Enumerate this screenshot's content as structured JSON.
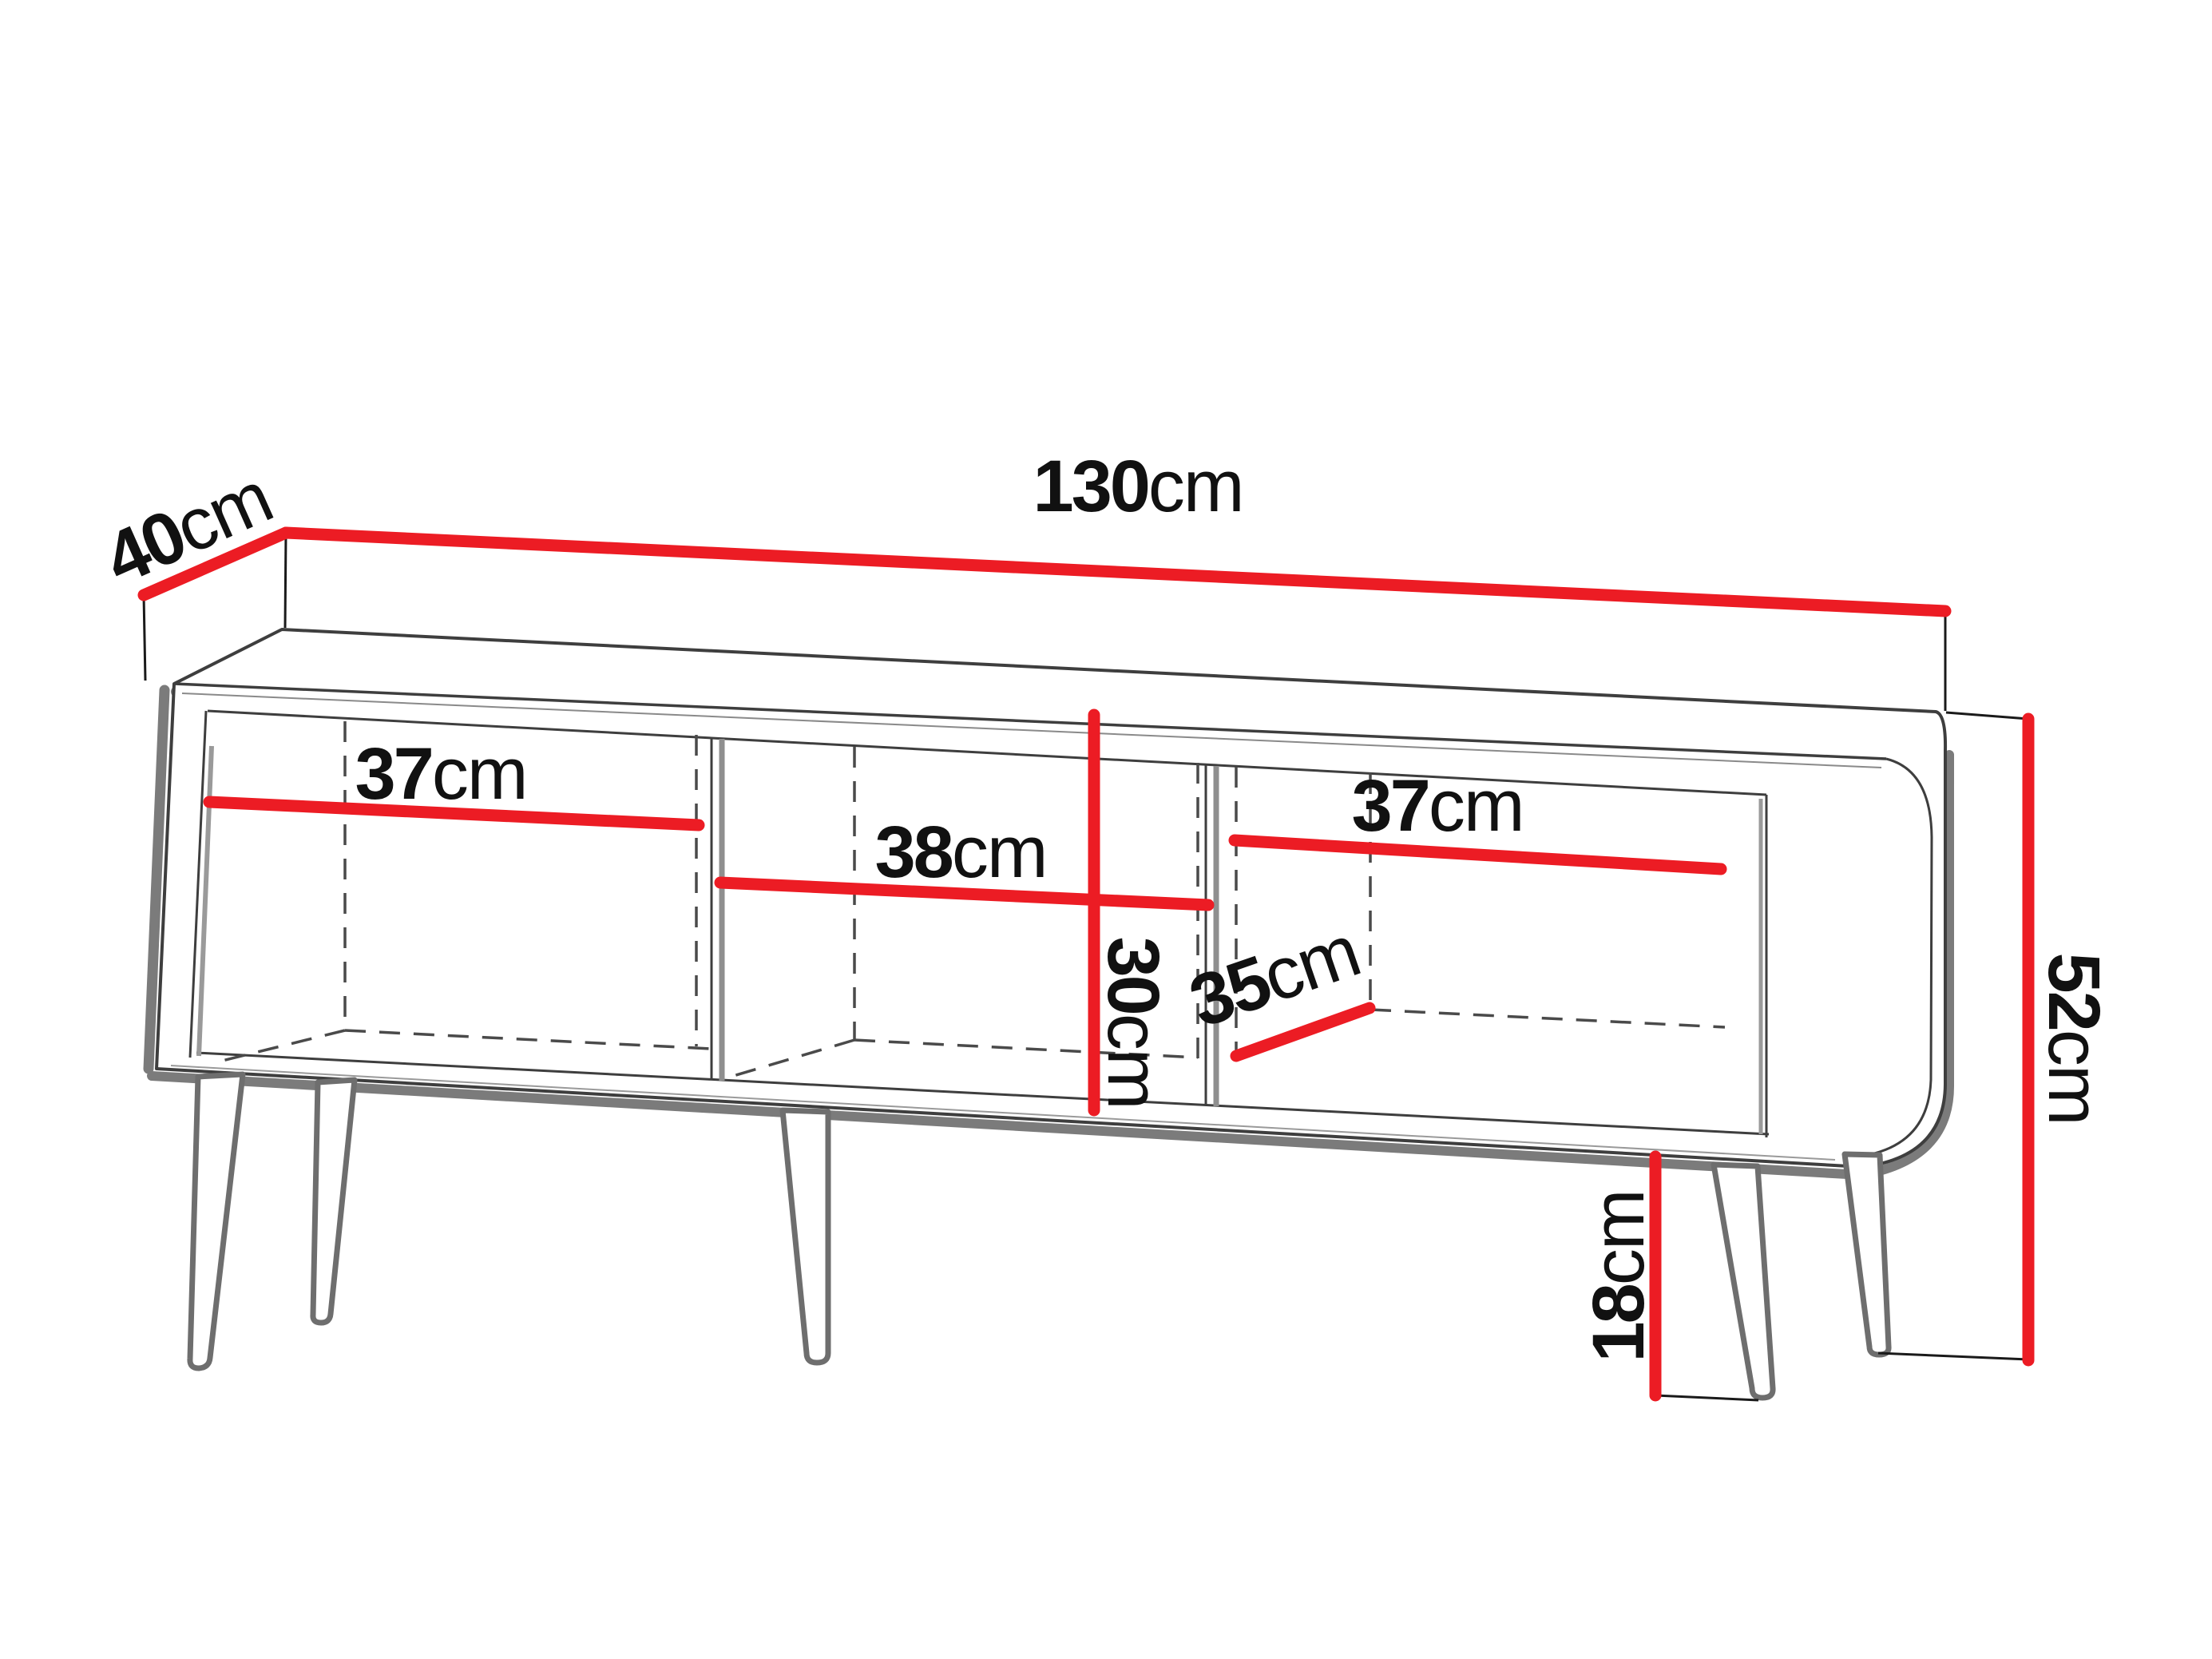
{
  "diagram_type": "furniture-dimension-diagram",
  "subject": "tv-stand-three-compartments-tapered-legs",
  "unit": "cm",
  "colors": {
    "dimension_line": "#EC1C24",
    "outline": "#3E3E3E",
    "shadow": "#7B7B7B",
    "dashed_line": "#4A4A4A",
    "text": "#111111",
    "background": "#FFFFFF"
  },
  "dims": {
    "width": {
      "value": "130",
      "unit": "cm"
    },
    "depth": {
      "value": "40",
      "unit": "cm"
    },
    "height": {
      "value": "52",
      "unit": "cm"
    },
    "left_compartment_width": {
      "value": "37",
      "unit": "cm"
    },
    "middle_compartment_width": {
      "value": "38",
      "unit": "cm"
    },
    "right_compartment_width": {
      "value": "37",
      "unit": "cm"
    },
    "inner_height": {
      "value": "30",
      "unit": "cm"
    },
    "inner_depth": {
      "value": "35",
      "unit": "cm"
    },
    "leg_height": {
      "value": "18",
      "unit": "cm"
    }
  }
}
